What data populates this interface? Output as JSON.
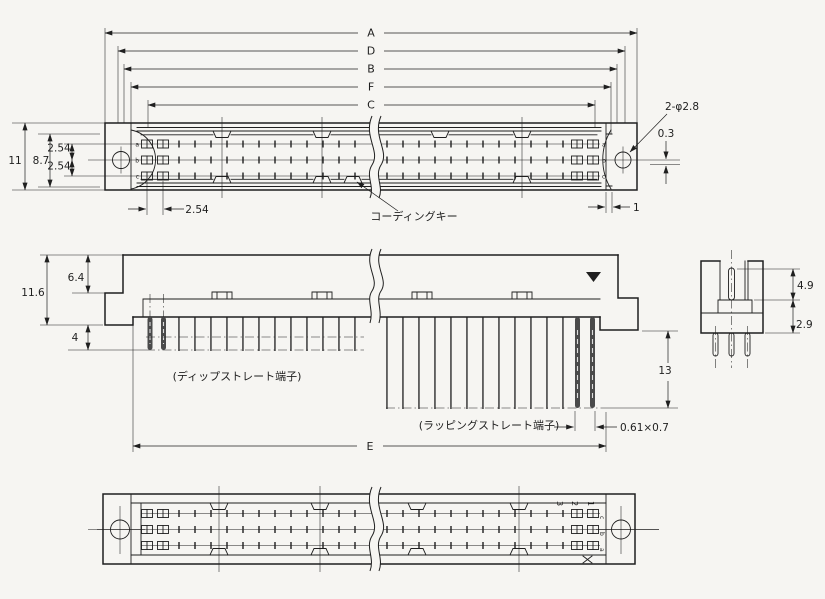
{
  "colors": {
    "background": "#f6f5f2",
    "ink": "#1f1f1f"
  },
  "top_view": {
    "dim_a": "A",
    "dim_d": "D",
    "dim_b": "B",
    "dim_f": "F",
    "dim_c": "C",
    "overall_height": "11",
    "rows_height": "8.7",
    "row_pitch_upper": "2.54",
    "row_pitch_lower": "2.54",
    "col_pitch": "2.54",
    "holes_label": "2-φ2.8",
    "offset_label": "0.3",
    "end_gap": "1",
    "coding_key": "コーディングキー",
    "row_labels": [
      "a",
      "b",
      "c"
    ]
  },
  "front_view": {
    "total_height": "11.6",
    "shroud_height": "6.4",
    "dip_length": "4",
    "wrap_length": "13",
    "pin_section": "0.61×0.7",
    "dim_e": "E",
    "dip_label": "(ディップストレート端子)",
    "wrap_label": "(ラッピングストレート端子)"
  },
  "side_view": {
    "upper_depth": "4.9",
    "lower_height": "2.9"
  },
  "bottom_view": {
    "col_labels": [
      "1",
      "2",
      "3"
    ],
    "row_labels": [
      "c",
      "b",
      "a"
    ]
  }
}
